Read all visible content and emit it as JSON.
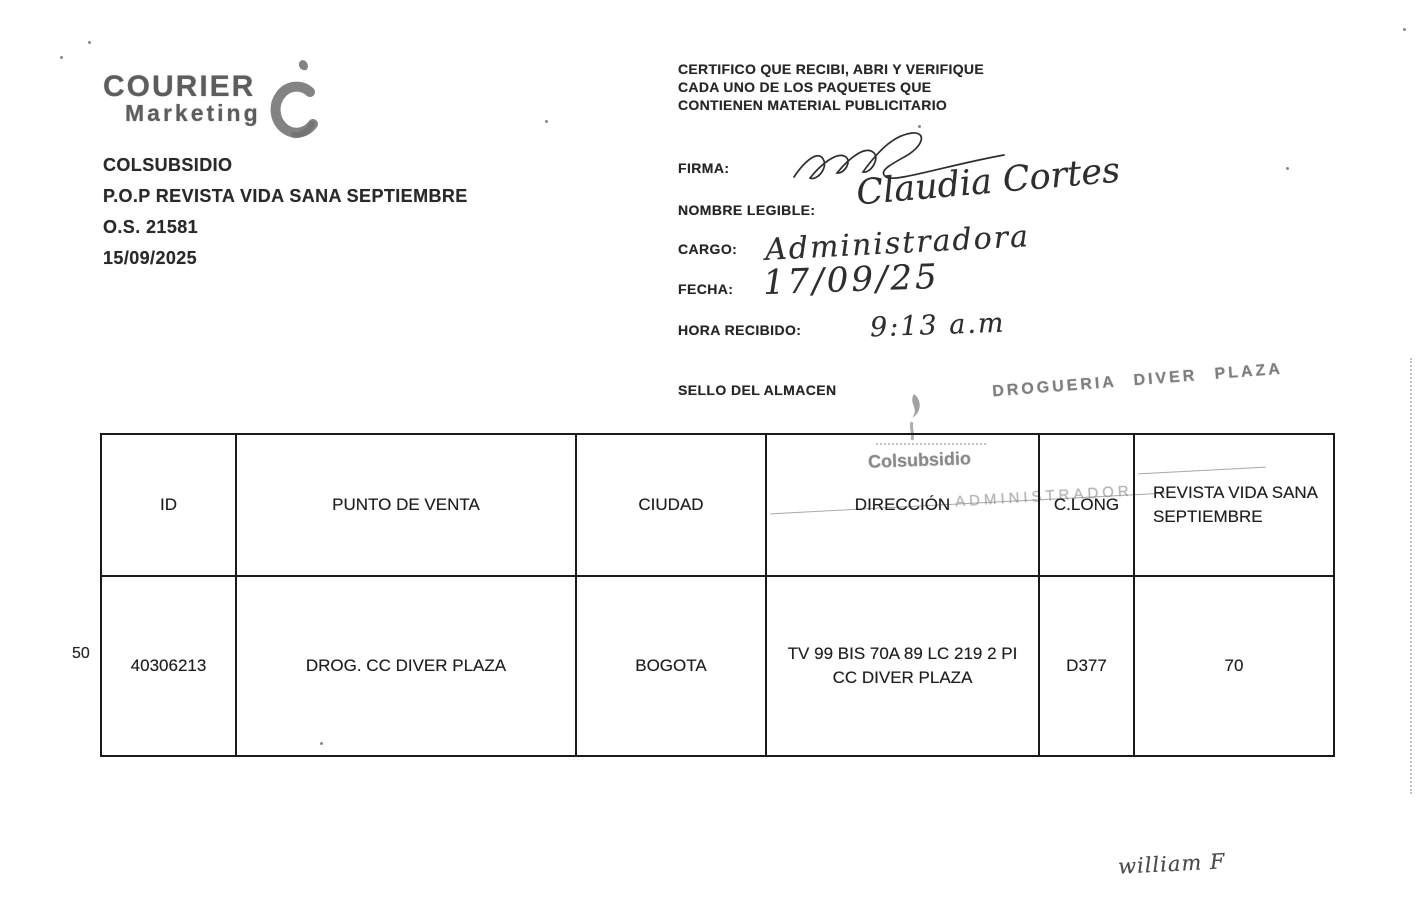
{
  "logo": {
    "name": "COURIER",
    "subname": "Marketing",
    "mark_icon": "c-swoosh-icon",
    "gray": "#5d5d5d"
  },
  "order_block": {
    "client": "COLSUBSIDIO",
    "campaign": "P.O.P REVISTA VIDA SANA SEPTIEMBRE",
    "order": "O.S. 21581",
    "date": "15/09/2025"
  },
  "certificate": {
    "lines": [
      "CERTIFICO QUE RECIBI, ABRI Y VERIFIQUE",
      "CADA  UNO DE LOS PAQUETES QUE",
      "CONTIENEN MATERIAL PUBLICITARIO"
    ]
  },
  "fields": [
    {
      "label": "FIRMA:",
      "value": ""
    },
    {
      "label": "NOMBRE LEGIBLE:",
      "value": "Claudia Cortes"
    },
    {
      "label": "CARGO:",
      "value": "Administradora"
    },
    {
      "label": "FECHA:",
      "value": "17/09/25"
    },
    {
      "label": "HORA RECIBIDO:",
      "value": "9:13 a.m"
    }
  ],
  "sello": {
    "label": "SELLO DEL ALMACEN",
    "store_stamp": "DROGUERIA  DIVER  PLAZA",
    "brand_stamp": "Colsubsidio",
    "role_stamp": "ADMINISTRADOR",
    "stamp_color": "#7e7e7e"
  },
  "table": {
    "row_number": "50",
    "headers": [
      "ID",
      "PUNTO DE VENTA",
      "CIUDAD",
      "DIRECCIÓN",
      "C.LONG",
      "REVISTA VIDA SANA SEPTIEMBRE"
    ],
    "rows": [
      [
        "40306213",
        "DROG. CC DIVER PLAZA",
        "BOGOTA",
        "TV 99 BIS 70A 89 LC 219 2 PI CC DIVER PLAZA",
        "D377",
        "70"
      ]
    ]
  },
  "footer": {
    "signature": "william F"
  }
}
